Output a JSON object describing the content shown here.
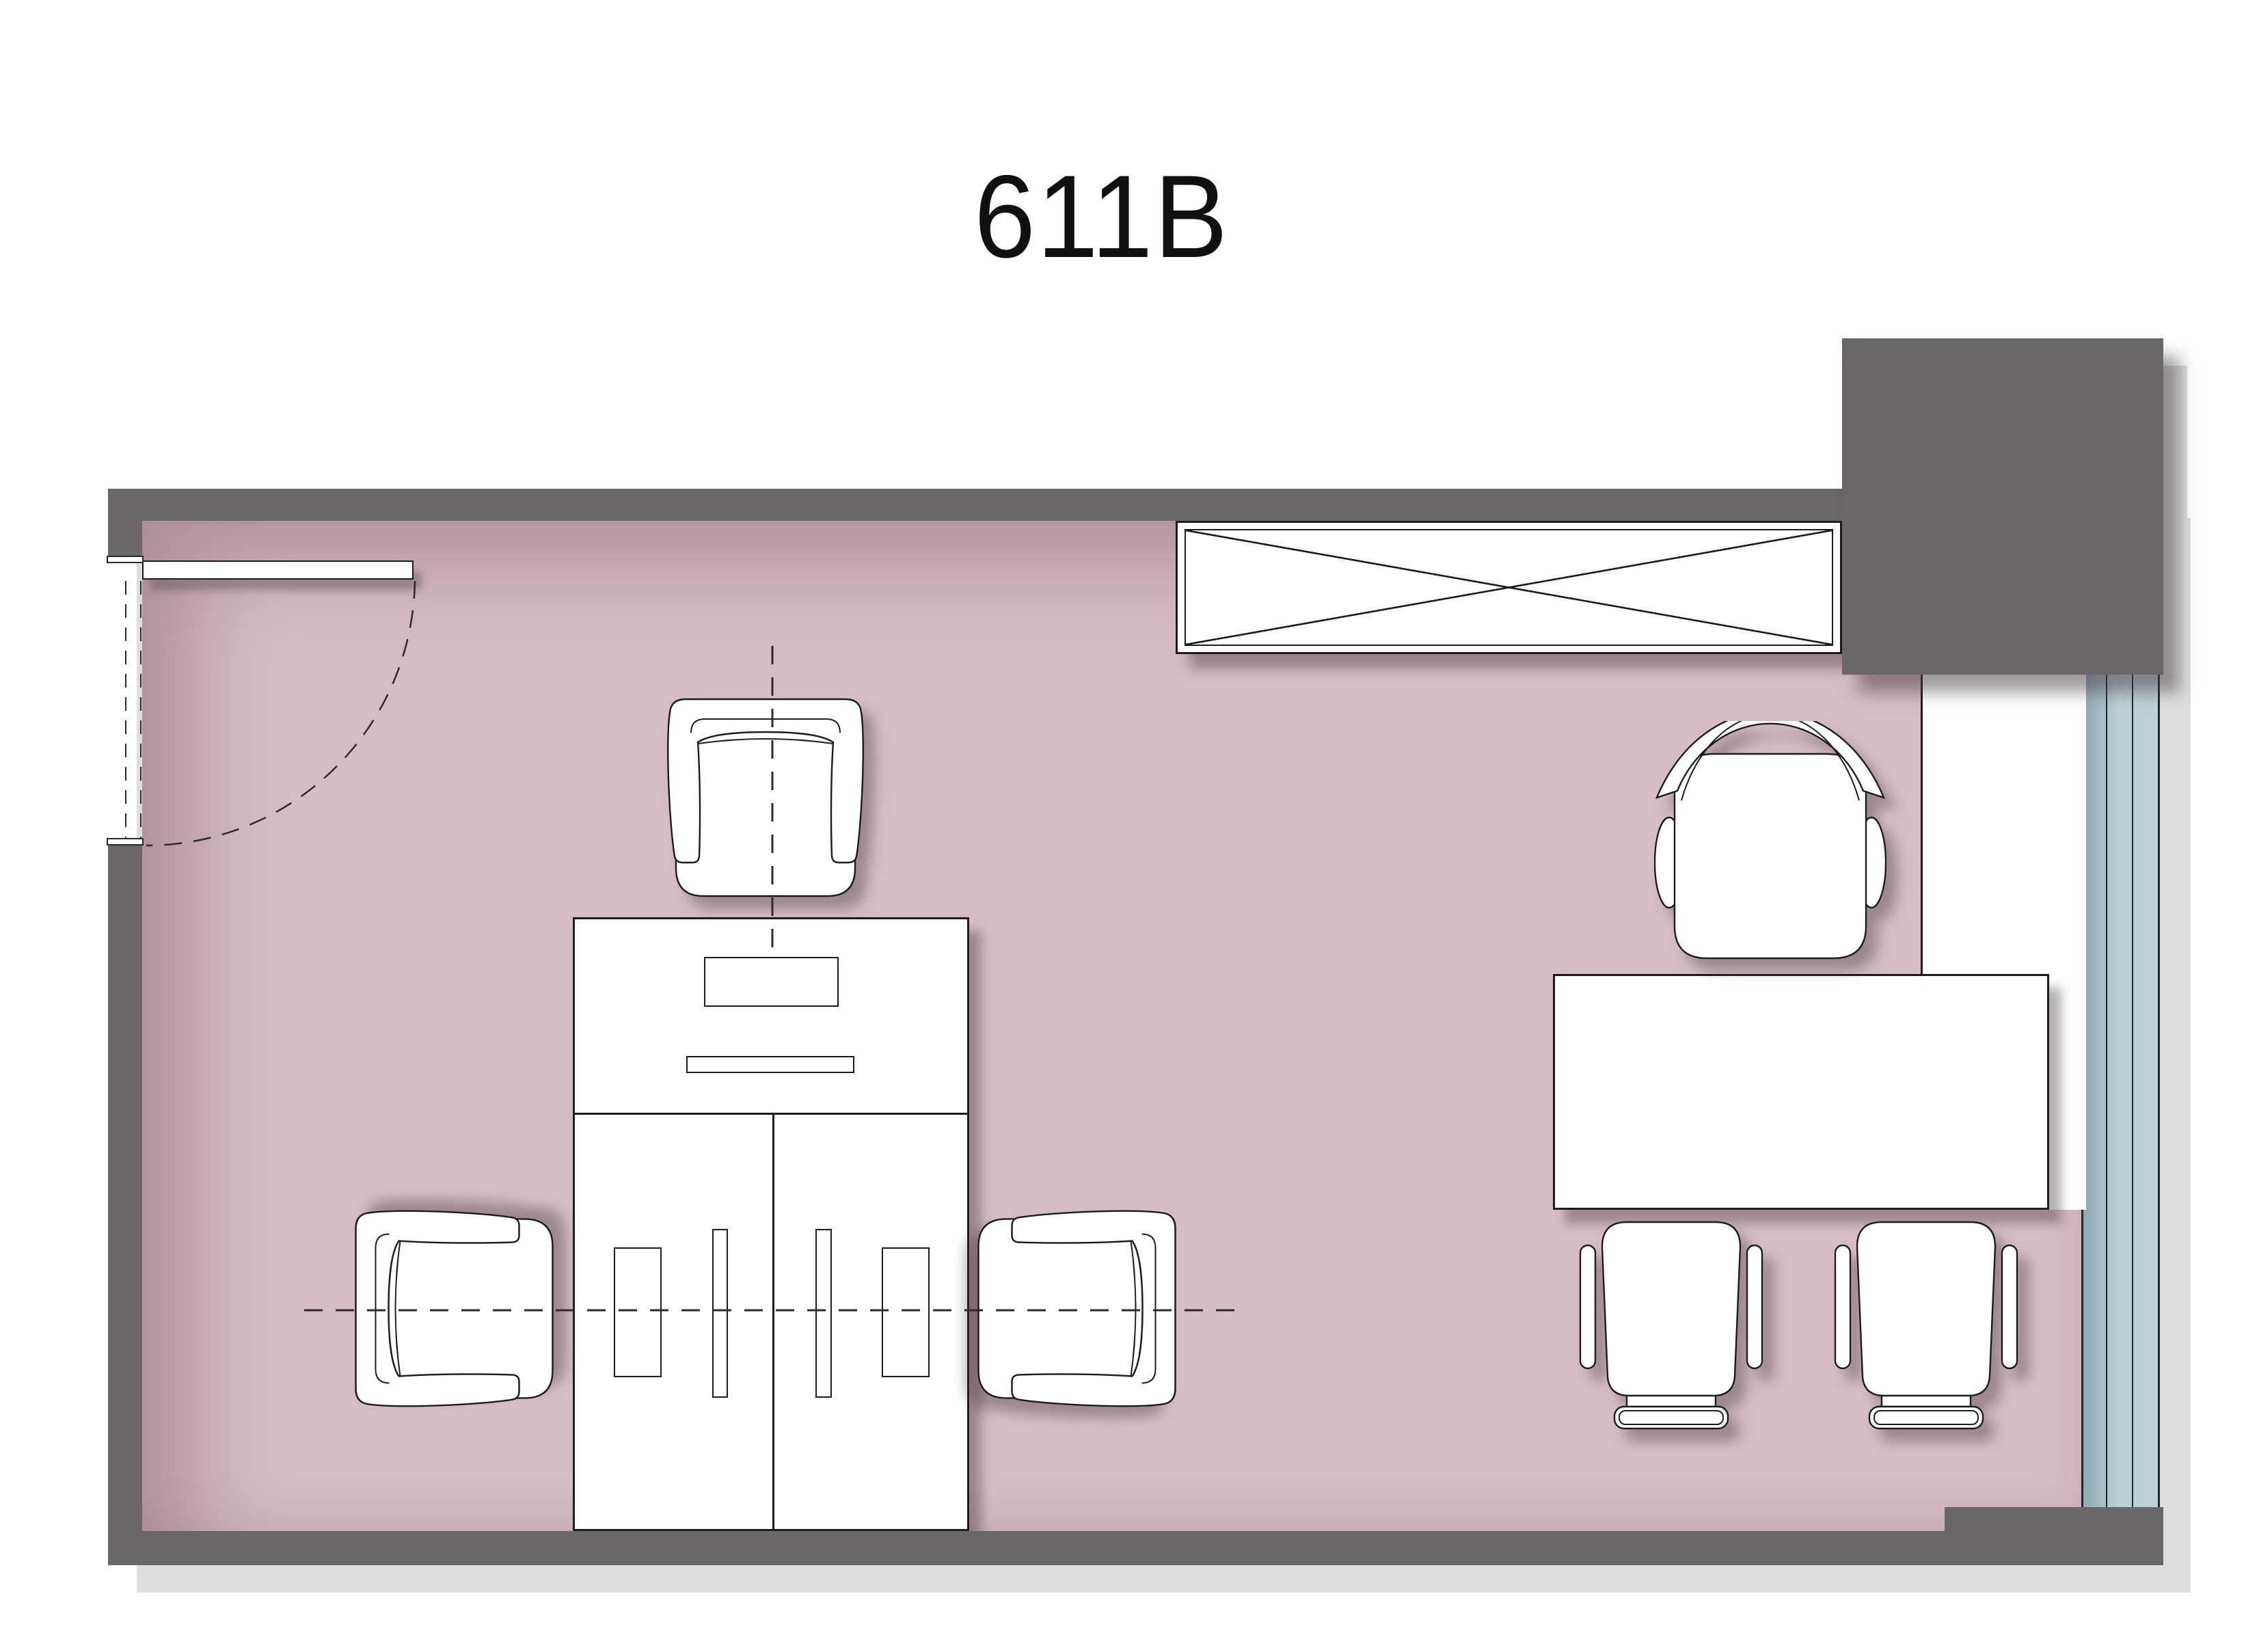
{
  "title": "611B",
  "colors": {
    "wall": "#6b6769",
    "floor": "#d6bcc4",
    "glass": "#bbd1d5",
    "glass_dark": "#8fa9b1",
    "line": "#1c1c1c",
    "dash": "#2b2b2b",
    "page_shadow": "#dedede",
    "furniture": "#ffffff"
  }
}
